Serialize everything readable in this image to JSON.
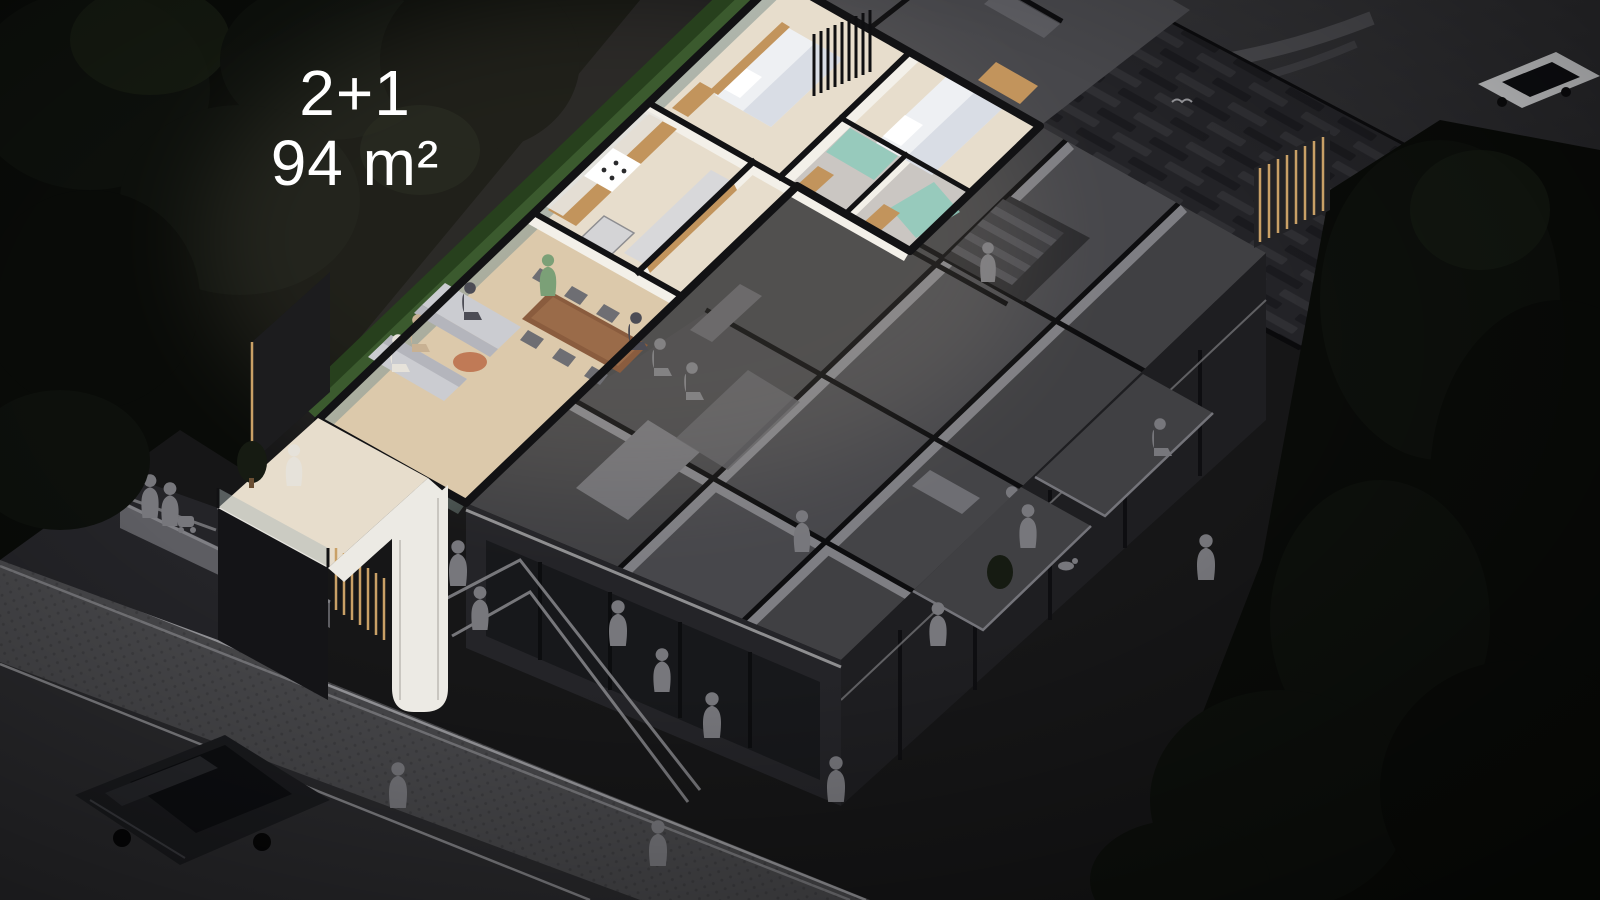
{
  "label": {
    "unit_type": "2+1",
    "unit_area": "94 m²"
  },
  "scene": {
    "kind": "isometric-night-cutaway-apartment-render",
    "highlighted_unit": {
      "name": "2+1 apartment, 94 m²",
      "rooms": [
        "living-room",
        "dining-area",
        "kitchen",
        "hallway",
        "bedroom",
        "master-bedroom",
        "bathroom",
        "ensuite-bathroom",
        "balcony"
      ]
    },
    "surroundings": [
      "darkened-neighbour-units",
      "staircase",
      "front-balconies",
      "street-sidewalk",
      "parked-suv",
      "pedestrians",
      "dog",
      "stroller",
      "woven-pergola-roof",
      "roundabout-road",
      "white-car",
      "trees",
      "hedge"
    ]
  },
  "colors": {
    "bg": "#161617",
    "label_text": "#ffffff",
    "trees": "#0d100c",
    "trees_dark": "#090b08",
    "trees_light": "#161b12",
    "road_line": "#48484c",
    "pergola_base": "#232327",
    "pergola_bar_light": "#2f2f33",
    "pergola_bar_dark": "#1a1a1e",
    "gray_floor": "#404043",
    "gray_floor_alt": "#47474b",
    "gray_wall_top": "#0d0d0f",
    "gray_wall_face": "#7e7e83",
    "gray_furniture": "#5d5d62",
    "gray_furniture_light": "#6e6e73",
    "people_gray": "#77777c",
    "facade_se": "#1e1e21",
    "facade_sw": "#242428",
    "storefront_glass": "#17181b",
    "sidewalk": "#48484b",
    "cobble_dot": "#3e3e41",
    "road": "#2a2a2d",
    "curb": "#97979b",
    "car_body": "#1a1b1e",
    "car_glass": "#0d0e11",
    "white_car": "#cfd0d2",
    "hl_floor": "#e7ddcc",
    "hl_floor_wood": "#dcc9ab",
    "hl_wall_top": "#121214",
    "hl_wall_face": "#f3f0e9",
    "hedge": "#3b5a2e",
    "hedge_dark": "#27401d",
    "wood": "#c2945c",
    "wood_dark": "#8a5c3e",
    "sofa": "#cbccd1",
    "sofa_dark": "#b4b5bc",
    "bed_white": "#eef0f3",
    "bed_shadow": "#d9dde5",
    "teal": "#8ecabb",
    "marble": "#cac6c2",
    "table_round": "#c07a56",
    "gold": "#c9a066",
    "white_band": "#eceae4",
    "balcony_glass": "#a9b6b6",
    "person_green": "#7ba077",
    "person_tan": "#c8b193",
    "person_dark": "#4c4c55",
    "person_white": "#e6e2da"
  }
}
